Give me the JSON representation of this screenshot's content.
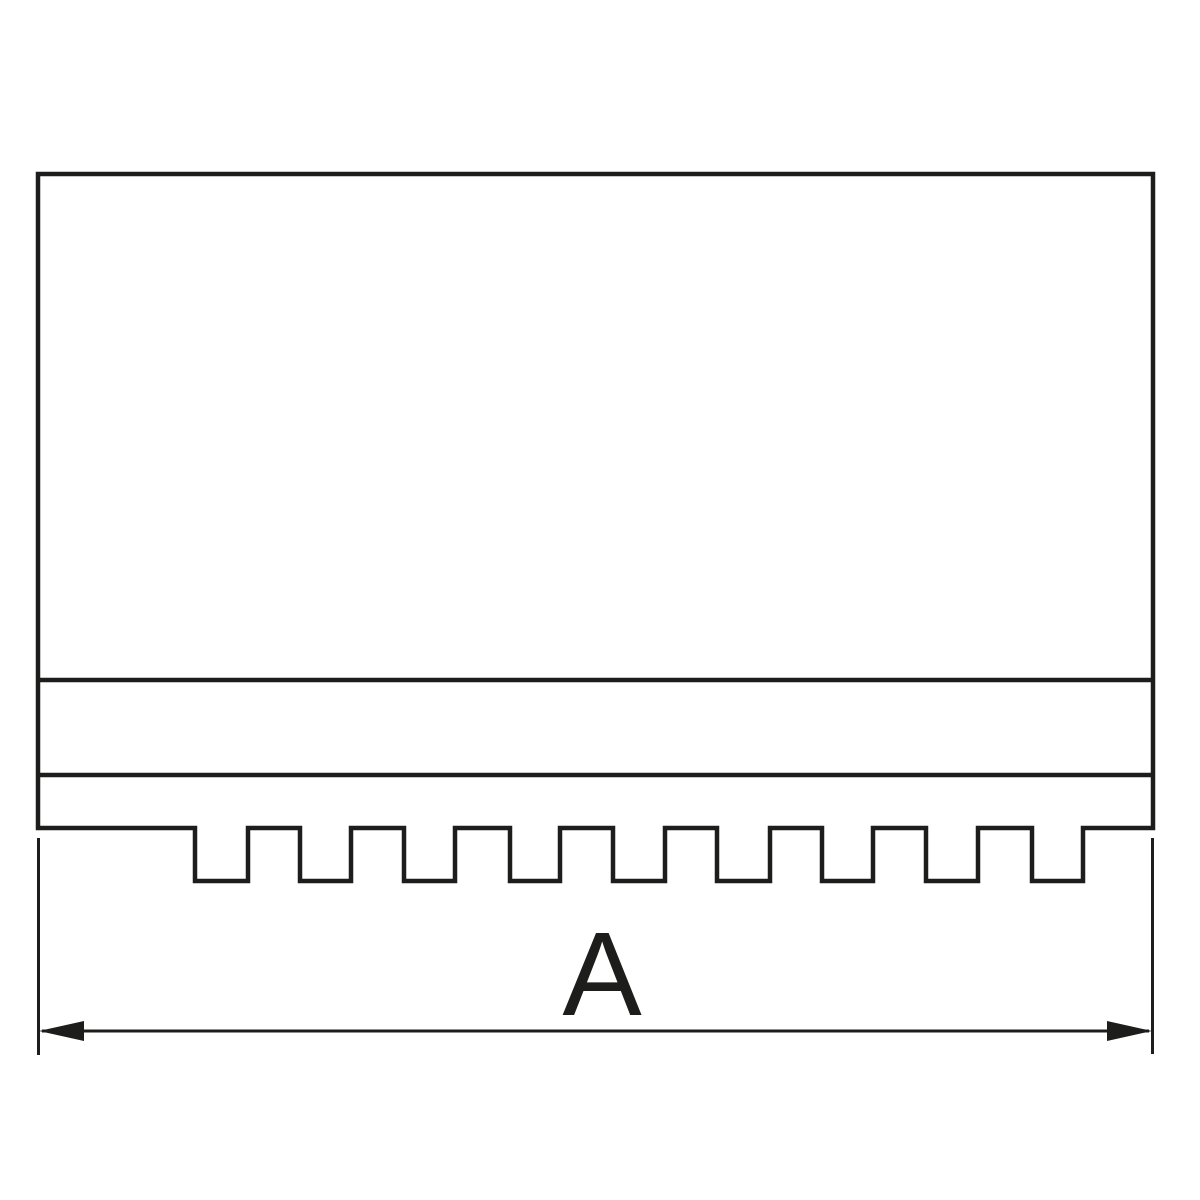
{
  "canvas": {
    "width": 1200,
    "height": 1200,
    "background": "#ffffff"
  },
  "drawing": {
    "kind": "technical line drawing, side profile of a serrated soft jaw",
    "line_color": "#1d1d1b",
    "outline_stroke_width": 4.5,
    "thin_stroke_width": 3,
    "bands": {
      "body_top_y": 174,
      "step_line_upper_y": 680,
      "step_line_lower_y": 775,
      "base_bottom_y": 828,
      "serration_bottom_y": 881
    },
    "serration": {
      "notch_count": 9,
      "notch_pitch_px": 105,
      "notch_width_px": 52
    },
    "dimension": {
      "label": "A",
      "line_y": 1031,
      "left_x": 38,
      "right_x": 1153,
      "arrow_style": "filled-triangle"
    }
  }
}
